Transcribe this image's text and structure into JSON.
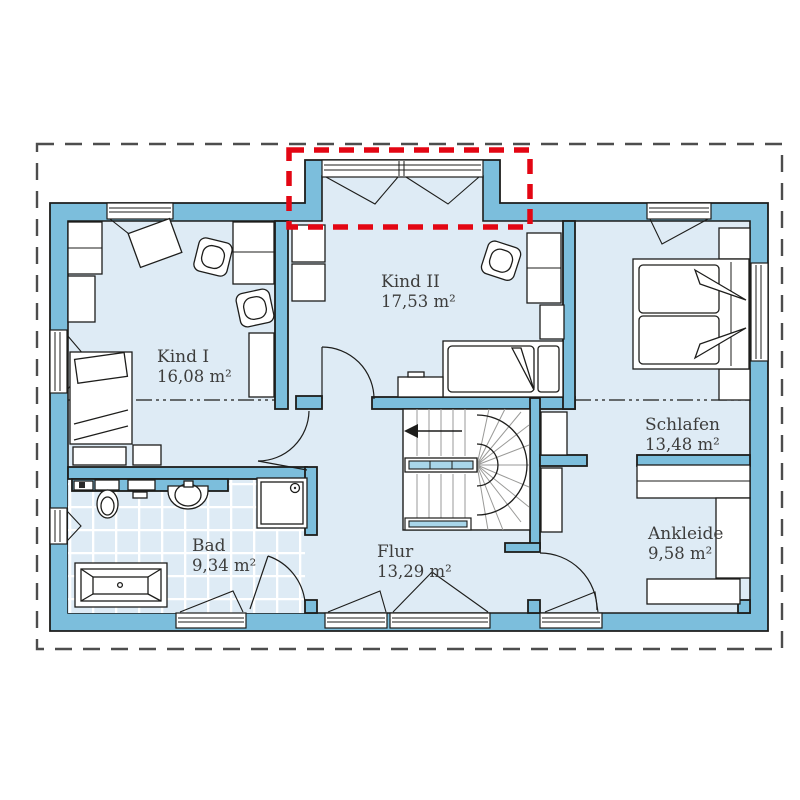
{
  "plan": {
    "type": "floor-plan-upper-storey",
    "rooms": [
      {
        "name": "Kind I",
        "area": "16,08 m²"
      },
      {
        "name": "Kind II",
        "area": "17,53 m²"
      },
      {
        "name": "Schlafen",
        "area": "13,48 m²"
      },
      {
        "name": "Ankleide",
        "area": "9,58 m²"
      },
      {
        "name": "Bad",
        "area": "9,34 m²"
      },
      {
        "name": "Flur",
        "area": "13,29 m²"
      }
    ],
    "colors": {
      "wall": "#7CBEDC",
      "floor": "#DEEBF5",
      "stair_rail": "#A9D6EA",
      "outline": "#1D1D1B",
      "dormer_marker_red": "#E30613",
      "plot_boundary_dash": "#4D4D4D",
      "label_text": "#3D3D3C",
      "tile_joint": "#FFFFFF"
    }
  }
}
